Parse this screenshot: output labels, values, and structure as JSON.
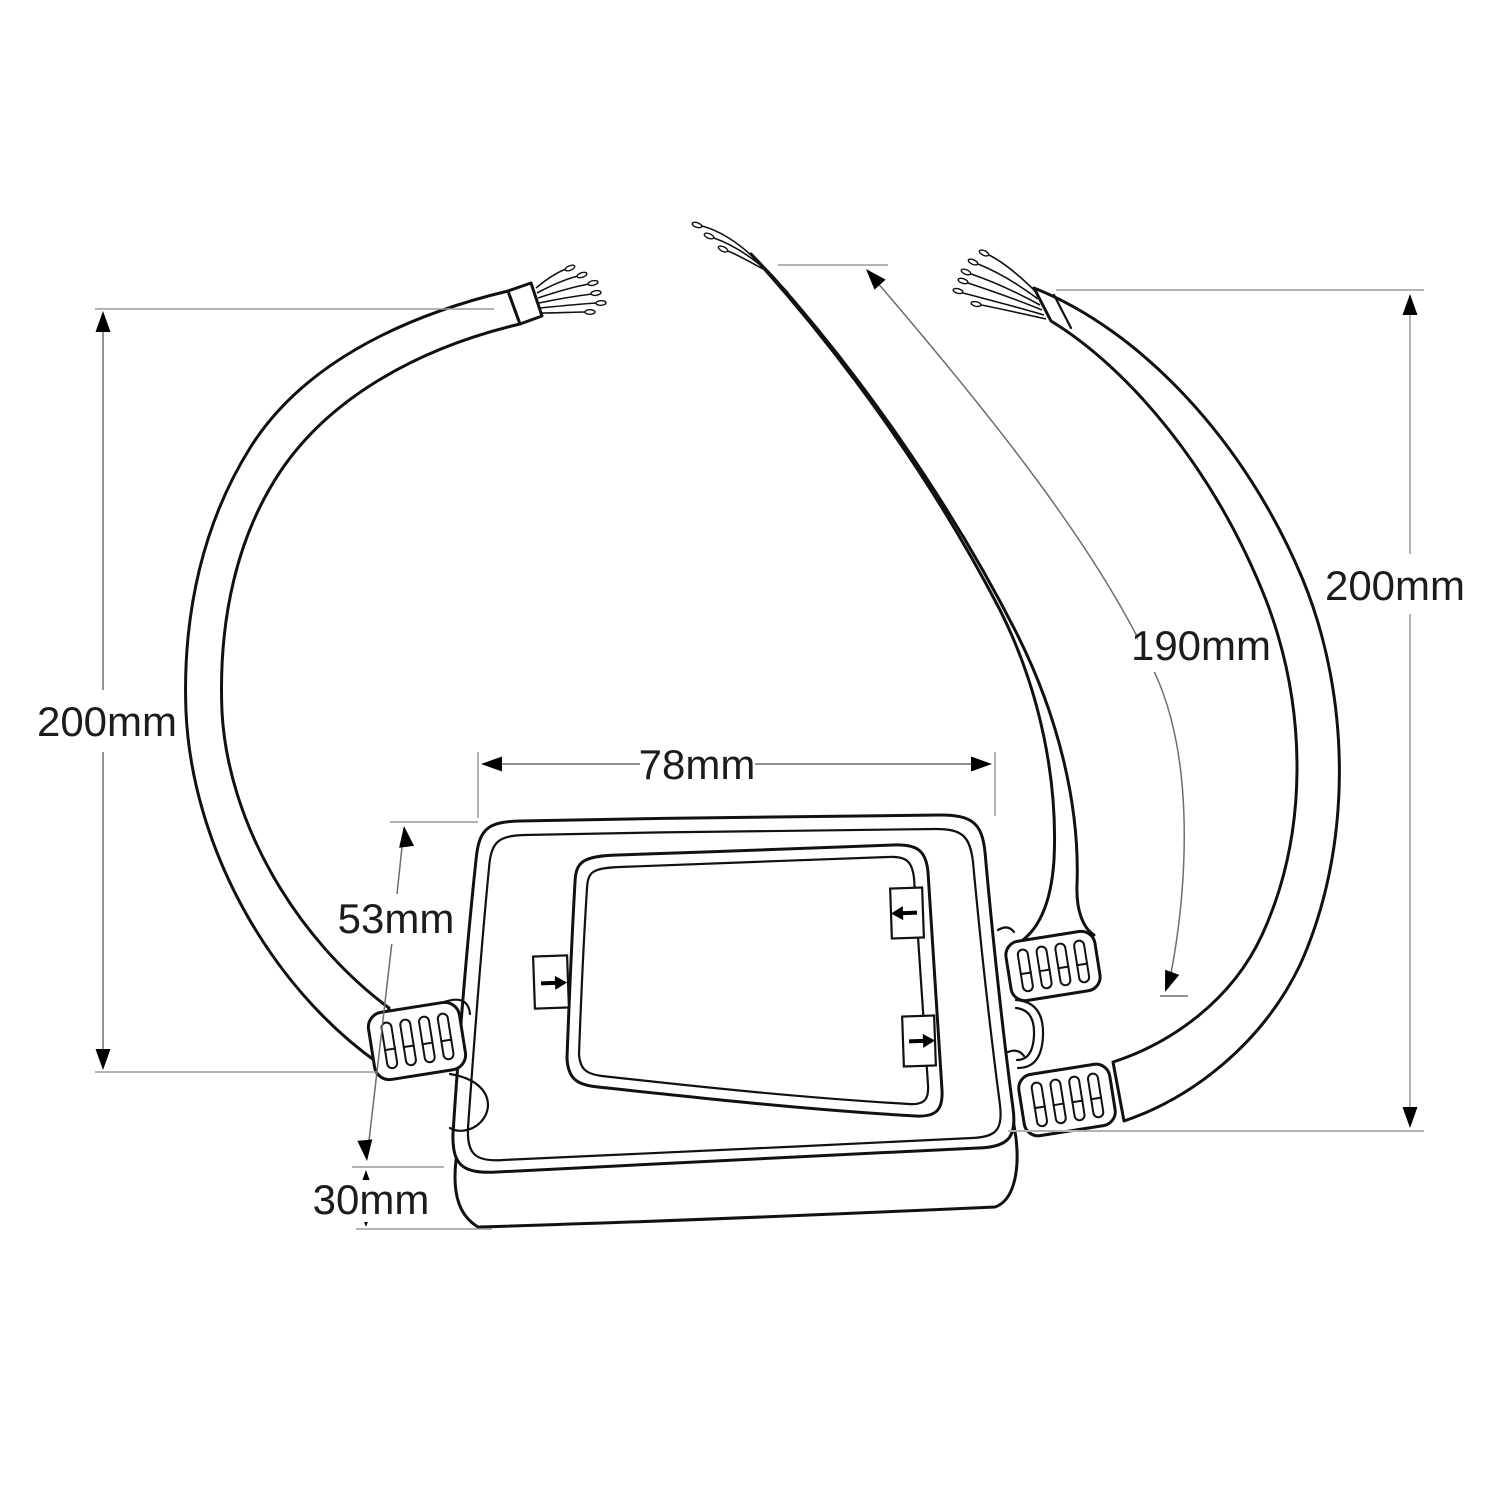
{
  "diagram": {
    "type": "technical_dimension_drawing",
    "subject": "Waterproof junction box with three stripped-end cables",
    "colors": {
      "line": "#111111",
      "dimension_line": "#6e6e6e",
      "extension_line": "#9a9a9a",
      "light_extension_line": "#b3b3b3",
      "arrowhead": "#000000",
      "background": "#ffffff"
    },
    "dimensions": {
      "left_cable": "200mm",
      "middle_cable": "190mm",
      "right_cable": "200mm",
      "box_width": "78mm",
      "box_lid_height": "53mm",
      "box_base_depth": "30mm"
    },
    "icons": {
      "lid_tab_left": "arrow-right-icon",
      "lid_tab_top_right": "arrow-left-icon",
      "lid_tab_bottom_right": "arrow-right-icon"
    }
  }
}
